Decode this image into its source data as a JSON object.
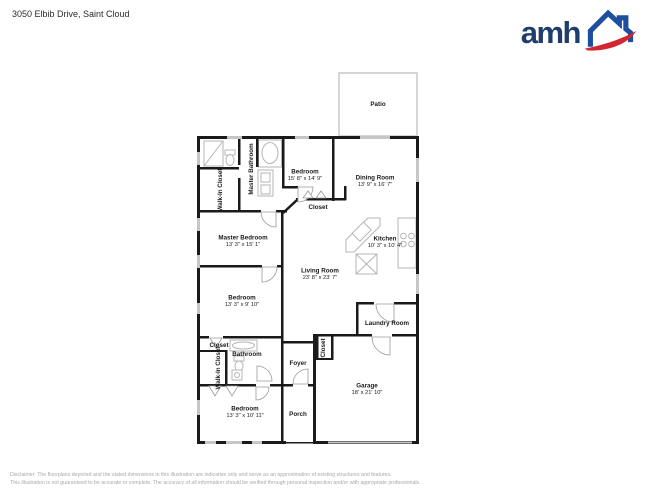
{
  "header": {
    "address": "3050 Elbib Drive, Saint Cloud"
  },
  "logo": {
    "text": "amh",
    "colors": {
      "navy": "#1e3c6e",
      "blue": "#1d4f9e",
      "red": "#d22630"
    }
  },
  "plan_colors": {
    "wall": "#1a1a1a",
    "window": "#c6c6c6",
    "fixture": "#b5b5b5",
    "patio_outline": "#c8c8c8"
  },
  "rooms": [
    {
      "name": "Patio",
      "dims": ""
    },
    {
      "name": "Master Bathroom",
      "dims": ""
    },
    {
      "name": "Walk-In Closet",
      "dims": ""
    },
    {
      "name": "Bedroom",
      "dims": "15' 8\" x 14' 9\""
    },
    {
      "name": "Dining Room",
      "dims": "13' 9\" x 16' 7\""
    },
    {
      "name": "Closet",
      "dims": ""
    },
    {
      "name": "Master Bedroom",
      "dims": "13' 3\" x 15' 1\""
    },
    {
      "name": "Kitchen",
      "dims": "10' 3\" x 10' 4\""
    },
    {
      "name": "Living Room",
      "dims": "23' 8\" x 23' 7\""
    },
    {
      "name": "Bedroom",
      "dims": "13' 3\" x 9' 10\""
    },
    {
      "name": "Laundry Room",
      "dims": ""
    },
    {
      "name": "Closet",
      "dims": ""
    },
    {
      "name": "Walk-In Closet",
      "dims": ""
    },
    {
      "name": "Bathroom",
      "dims": ""
    },
    {
      "name": "Closet",
      "dims": ""
    },
    {
      "name": "Foyer",
      "dims": ""
    },
    {
      "name": "Garage",
      "dims": "18' x 21' 10\""
    },
    {
      "name": "Bedroom",
      "dims": "13' 3\" x 10' 11\""
    },
    {
      "name": "Porch",
      "dims": ""
    }
  ],
  "footer": {
    "line1": "Disclaimer: The floorplans depicted and the stated dimensions in this illustration are indicative only and serve as an approximation of existing structures and features.",
    "line2": "This illustration is not guaranteed to be accurate or complete. The accuracy of all information should be verified through personal inspection and/or with appropriate professionals."
  }
}
